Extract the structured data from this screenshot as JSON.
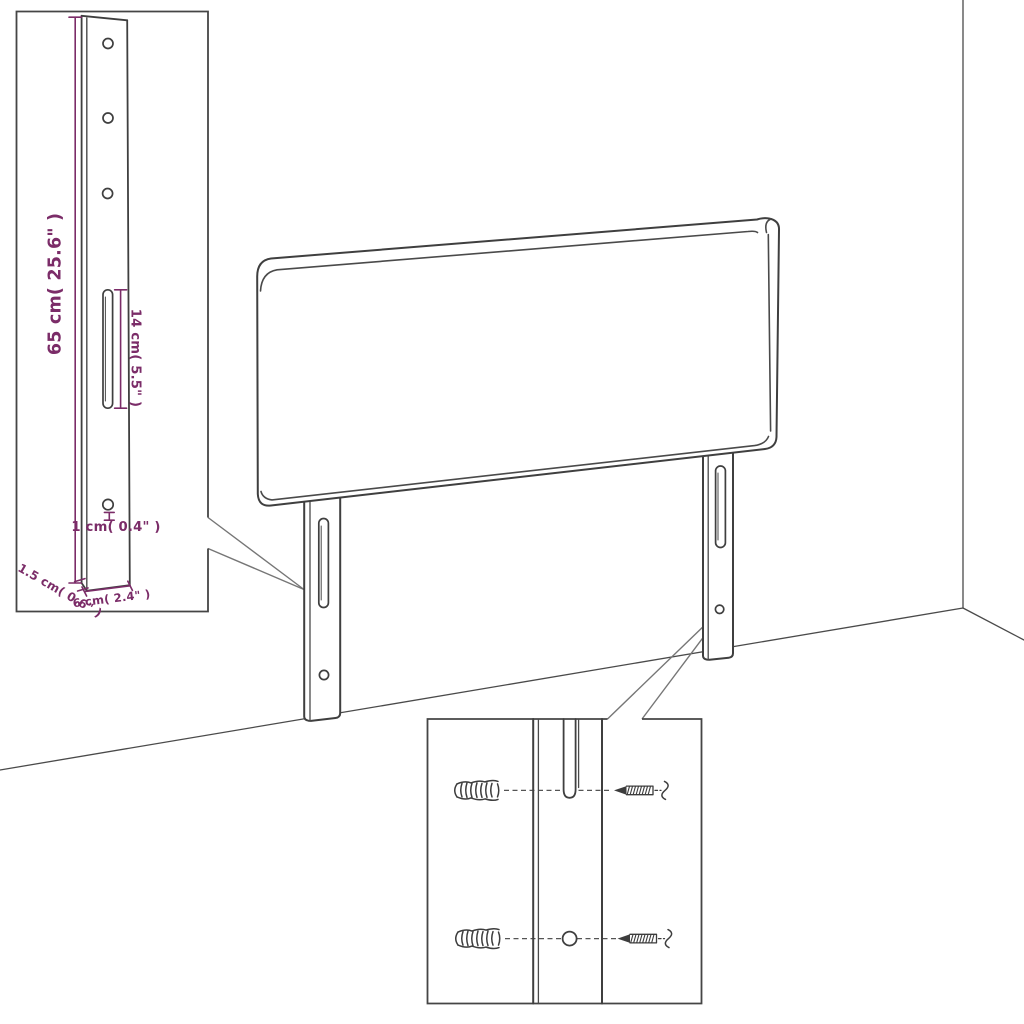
{
  "meta": {
    "subject": "headboard-with-mounting-legs-product-diagram",
    "background_color": "#ffffff",
    "outline_color": "#3f3f3f",
    "dimension_color": "#7b2c68"
  },
  "insets": {
    "leg_detail": {
      "dimensions": {
        "leg_height": "65 cm( 25.6\" )",
        "slot_length": "14 cm( 5.5\" )",
        "hole_diameter": "1 cm( 0.4\" )",
        "leg_thickness": "1.5 cm( 0.6\" )",
        "leg_width": "6 cm( 2.4\" )"
      }
    },
    "mounting_detail": {
      "hardware": [
        "wall-anchor-icon",
        "screw-icon"
      ],
      "hardware_counts": {
        "wall_anchors": 2,
        "screws": 2
      }
    }
  }
}
